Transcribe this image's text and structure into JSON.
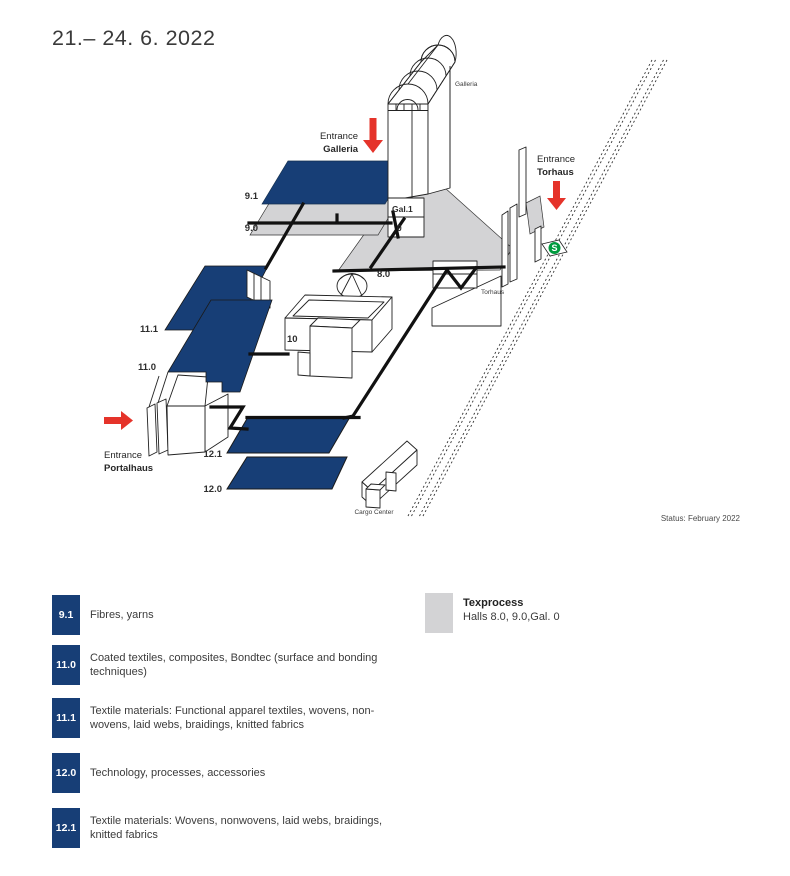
{
  "title": "21.– 24. 6. 2022",
  "status": "Status: February 2022",
  "map": {
    "labels": {
      "h91": "9.1",
      "h90": "9.0",
      "gal1": "Gal.1",
      "gal0": "0",
      "h80": "8.0",
      "h10": "10",
      "h111": "11.1",
      "h110": "11.0",
      "h121": "12.1",
      "h120": "12.0",
      "galleria": "Galleria",
      "torhaus": "Torhaus",
      "cargo_center": "Cargo Center",
      "sbahn": "S"
    },
    "entrances": {
      "galleria": {
        "line1": "Entrance",
        "line2": "Galleria"
      },
      "torhaus": {
        "line1": "Entrance",
        "line2": "Torhaus"
      },
      "portalhaus": {
        "line1": "Entrance",
        "line2": "Portalhaus"
      }
    }
  },
  "legend": {
    "items": [
      {
        "code": "9.1",
        "text": "Fibres, yarns"
      },
      {
        "code": "11.0",
        "text": "Coated textiles, composites, Bondtec (surface and bonding techniques)"
      },
      {
        "code": "11.1",
        "text": "Textile materials: Functional apparel textiles, wovens, non-wovens, laid webs, braidings, knitted fabrics"
      },
      {
        "code": "12.0",
        "text": "Technology, processes, accessories"
      },
      {
        "code": "12.1",
        "text": "Textile materials: Wovens, nonwovens, laid webs, braidings, knitted fabrics"
      }
    ],
    "texprocess": {
      "title": "Texprocess",
      "text": "Halls 8.0, 9.0,Gal. 0"
    }
  },
  "colors": {
    "hall_blue": "#173e76",
    "plate_gray": "#d3d3d5",
    "arrow_red": "#e5332a",
    "sbahn_green": "#009b3e"
  }
}
